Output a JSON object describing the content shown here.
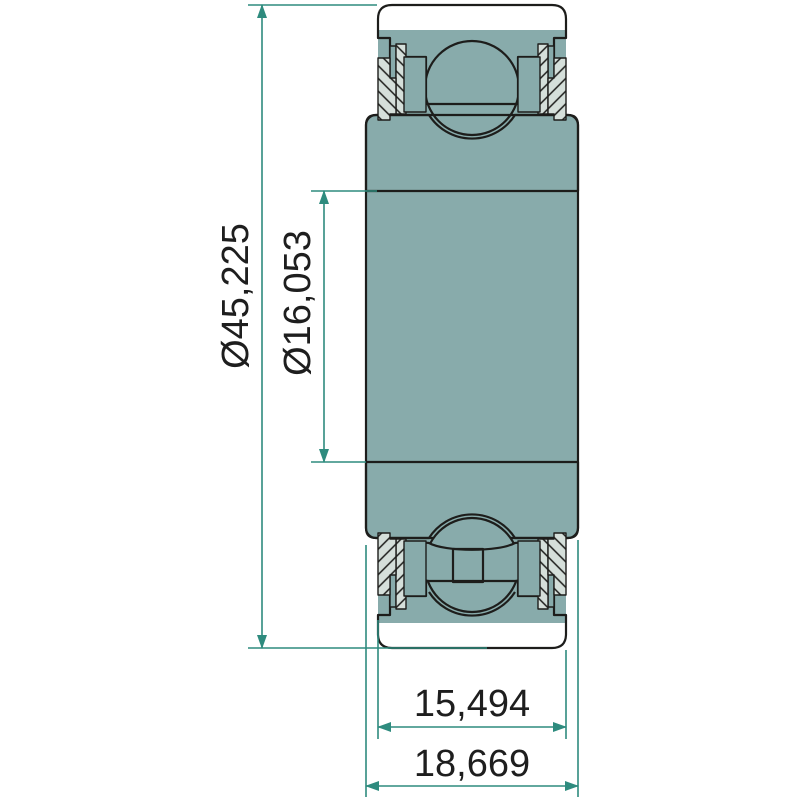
{
  "drawing": {
    "part": "radial-insert-ball-bearing-cross-section",
    "dims": {
      "outer_diameter": "Ø45,225",
      "bore_diameter": "Ø16,053",
      "outer_ring_width": "15,494",
      "total_width": "18,669"
    },
    "colors": {
      "c-dim": "#2e8b7e",
      "c-section": "#d5dfda",
      "c-solid": "#88abab",
      "c-outline": "#1d1d1b",
      "c-text": "#1e1e1e",
      "c-bg": "#ffffff"
    }
  }
}
